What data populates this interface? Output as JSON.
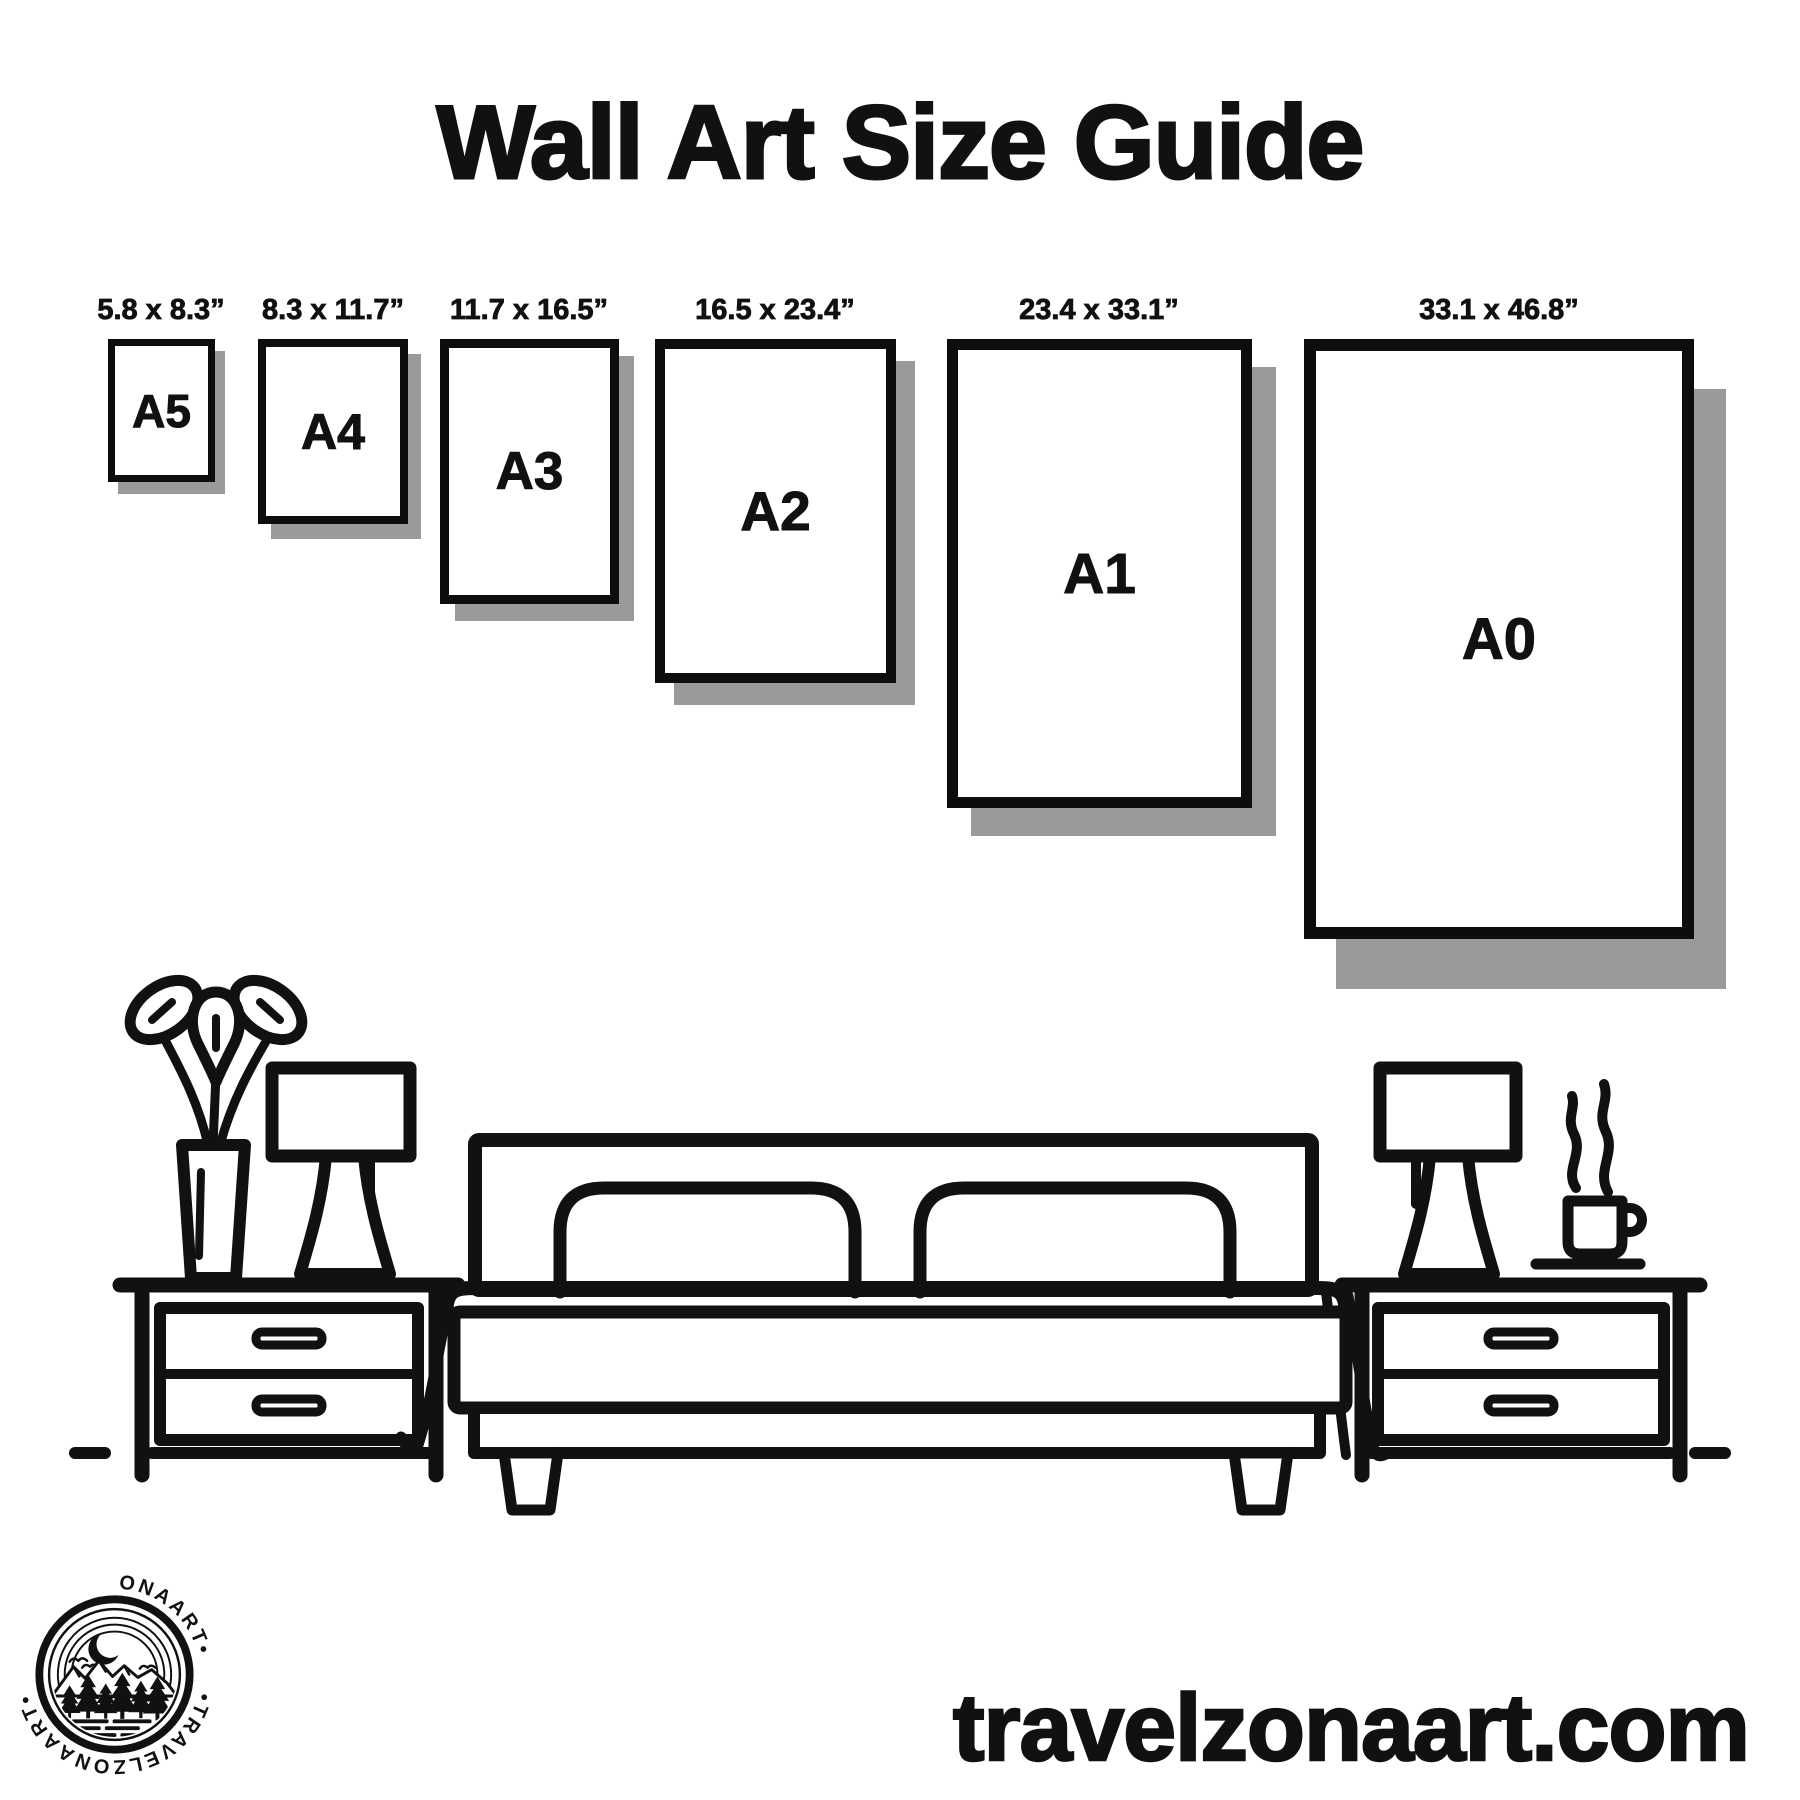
{
  "title": "Wall Art Size Guide",
  "frames": [
    {
      "name": "A5",
      "size_label": "5.8 x 8.3”"
    },
    {
      "name": "A4",
      "size_label": "8.3 x 11.7”"
    },
    {
      "name": "A3",
      "size_label": "11.7 x 16.5”"
    },
    {
      "name": "A2",
      "size_label": "16.5 x 23.4”"
    },
    {
      "name": "A1",
      "size_label": "23.4 x 33.1”"
    },
    {
      "name": "A0",
      "size_label": "33.1 x 46.8”"
    }
  ],
  "footer": {
    "website": "travelzonaart.com"
  },
  "logo": {
    "brand": "TRAVELZONAART",
    "arc_text_top": "•TRAVELZONAART•",
    "arc_text_bottom": "•TRAVELZONAART•"
  },
  "scene_icons": [
    "plant-vase-icon",
    "table-lamp-icon",
    "nightstand-icon",
    "bed-icon",
    "pillow-icon",
    "blanket-icon",
    "coffee-cup-icon",
    "steam-icon",
    "ground-line"
  ],
  "colors": {
    "ink": "#111111",
    "shadow": "#9a9a9a",
    "background": "#ffffff"
  }
}
